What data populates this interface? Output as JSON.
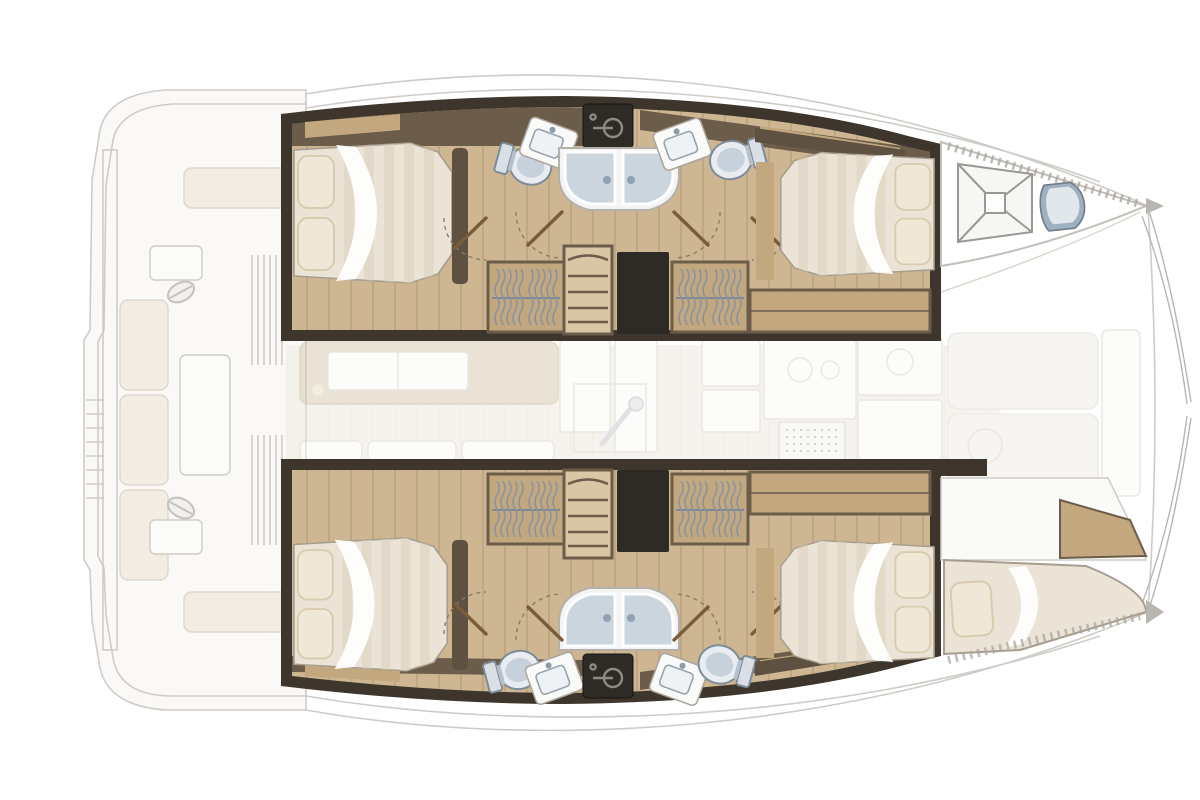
{
  "figure": {
    "kind": "floorplan-diagram",
    "subject": "catamaran-yacht-interior-top-view",
    "bow_side": "right",
    "stern_side": "left",
    "hull_count": 2,
    "double_cabins": 4,
    "bathrooms": 4
  },
  "colors": {
    "bg": "#ffffff",
    "ghost_line": "#cfccc7",
    "ghost_fill": "#faf9f8",
    "ghost_cushion": "#f2ece2",
    "saloon_floor": "#f0ebe2",
    "saloon_sofa": "#d9cbb4",
    "hull_dark": "#3e362d",
    "box_dark": "#2e2a25",
    "wood_mid": "#6c5c4a",
    "wood_tan": "#c3a87f",
    "floor_wood": "#cdb691",
    "floor_light": "#d9c6a4",
    "bed_base": "#eae3d6",
    "bed_stripe": "#ddd2c0",
    "pillow": "#f0e8d6",
    "pillow_edge": "#d8cbae",
    "fixture_blue": "#c7d1db",
    "fixture_blue_dark": "#9fb0c0",
    "fixture_edge": "#7e8c99",
    "glass": "#cbd5de",
    "arc_brown": "#8c7b63",
    "tick_gray": "#a9a5a0"
  },
  "components": {
    "cockpit_ghost": [
      "stern-platform",
      "transom-steps",
      "helm-station-upper",
      "helm-station-lower",
      "cockpit-bench-cushions",
      "cockpit-table",
      "saloon-door-slats"
    ],
    "upper_hull": [
      "aft-double-cabin",
      "aft-berth",
      "head-toilet-aft",
      "vanity-sink-aft",
      "shared-shower",
      "vanity-sink-fwd",
      "head-toilet-fwd",
      "hatch-logo-box",
      "wardrobe-aft",
      "companionway-stairs",
      "storage-locker",
      "wardrobe-fwd",
      "sideboard",
      "forward-double-cabin",
      "forward-berth",
      "bow-deck-hatch",
      "bow-head-toilet"
    ],
    "lower_hull": [
      "aft-double-cabin",
      "aft-berth",
      "head-toilet-aft",
      "vanity-sink-aft",
      "shared-shower",
      "vanity-sink-fwd",
      "head-toilet-fwd",
      "hatch-logo-box",
      "wardrobe-aft",
      "companionway-stairs",
      "storage-locker",
      "wardrobe-fwd",
      "sideboard",
      "forward-double-cabin",
      "forward-berth",
      "bow-single-berth"
    ],
    "saloon_ghost": [
      "sofa",
      "saloon-table",
      "seat-cushions",
      "nav-cabinet",
      "mast-post",
      "galley-fridge",
      "galley-counter",
      "shower-grate",
      "forward-lounge-pads",
      "forward-bench"
    ]
  }
}
